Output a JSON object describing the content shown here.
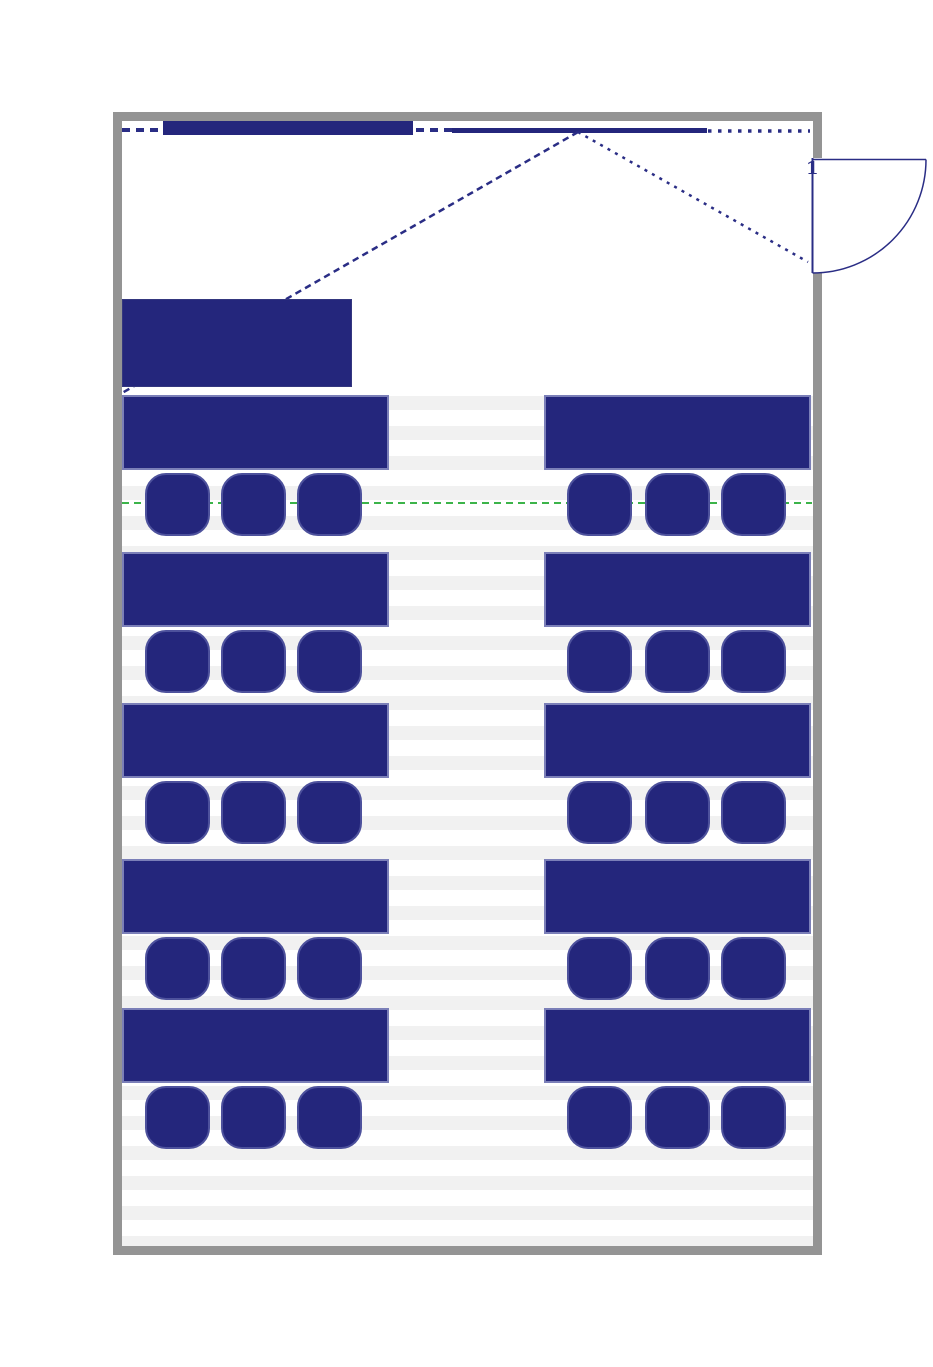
{
  "page": {
    "title": "Classroom floor plan"
  },
  "door": {
    "label": "1",
    "swing": "outward-right"
  },
  "colors": {
    "wall_gray": "#949494",
    "furniture_navy": "#24267c",
    "desk_border": "#7b7fb8",
    "chair_border": "#4d519c",
    "line_navy": "#2a2d85",
    "guide_green": "#3cb44a",
    "floor_stripe_gray": "#f1f1f1",
    "background": "#ffffff"
  },
  "floor_plan": {
    "room": {
      "x": 113,
      "y": 112,
      "width": 709,
      "height": 1143,
      "wall_thickness": 9
    },
    "door_opening": {
      "wall": "right",
      "y_start": 158,
      "y_end": 273
    },
    "whiteboard": {
      "x": 163,
      "y": 121,
      "width": 250,
      "height": 14
    },
    "projection_screen": {
      "x": 452,
      "y": 128,
      "width": 255,
      "height": 5
    },
    "beam_apex": {
      "x": 578,
      "y": 132
    },
    "beam_ends": [
      {
        "x": 122,
        "y": 393
      },
      {
        "x": 808,
        "y": 262
      }
    ],
    "teacher_desk": {
      "x": 122,
      "y": 299,
      "width": 230,
      "height": 88
    },
    "guide_line_y": 503,
    "stripes": {
      "x": 122,
      "y": 396,
      "width": 691,
      "height": 850,
      "gray_band": 14,
      "period": 30
    },
    "desk_rows_y": [
      395,
      552,
      703,
      859,
      1008
    ],
    "desk_height": 75,
    "columns": [
      {
        "name": "left",
        "desk_x": 122,
        "desk_width": 267,
        "chairs_x": [
          145,
          221,
          297
        ]
      },
      {
        "name": "right",
        "desk_x": 544,
        "desk_width": 267,
        "chairs_x": [
          567,
          645,
          721
        ]
      }
    ],
    "chair": {
      "width": 65,
      "height": 63,
      "offset_y": 78
    },
    "counts": {
      "student_desks": 10,
      "chairs": 30,
      "rows": 5,
      "columns": 2
    }
  }
}
